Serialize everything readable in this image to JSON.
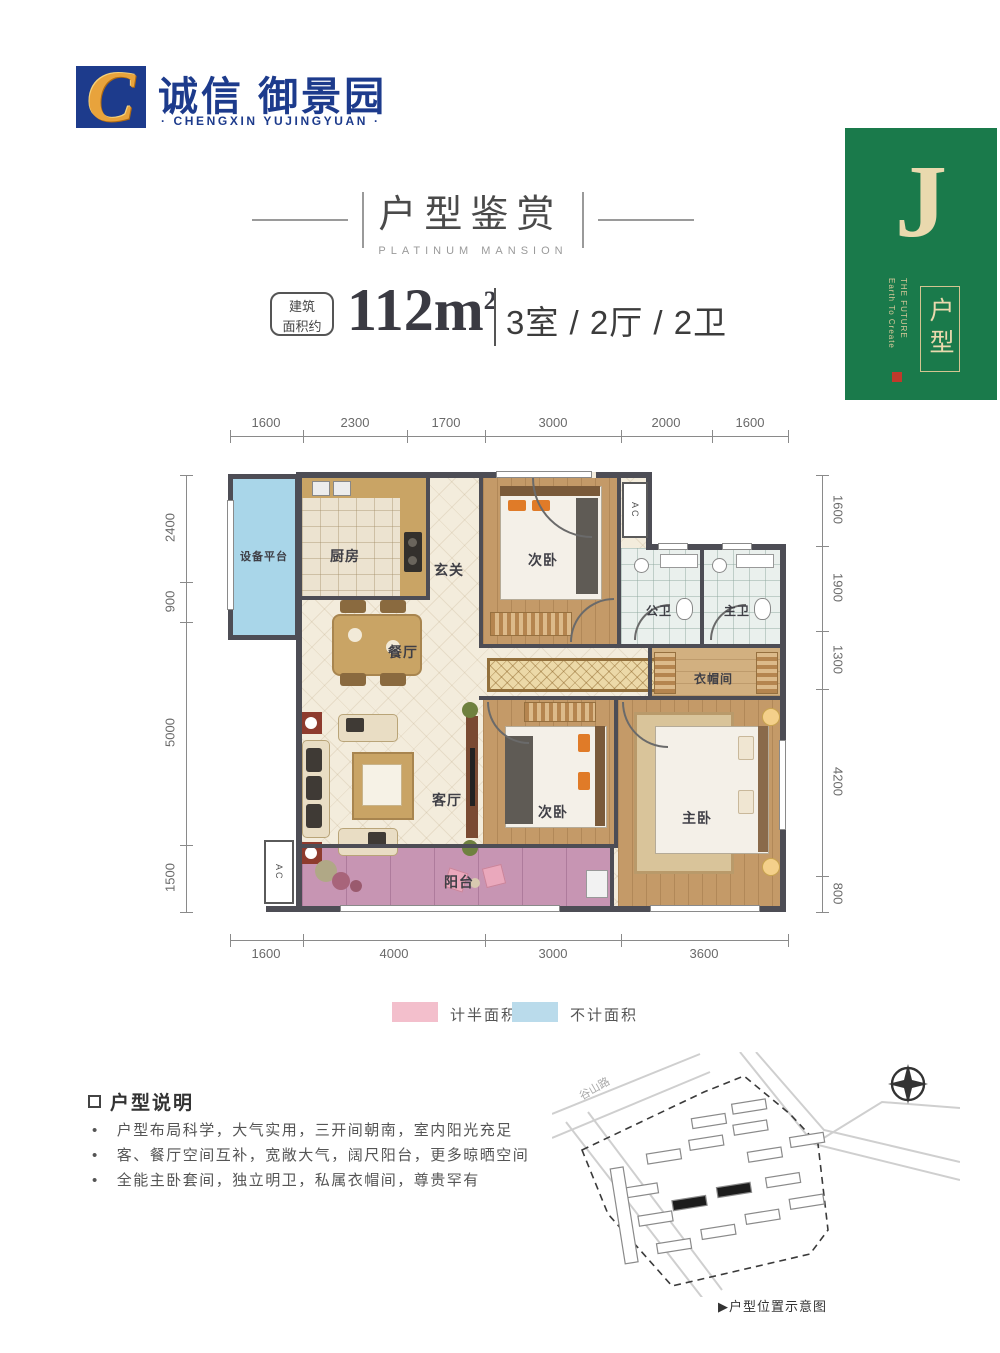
{
  "brand": {
    "logo_letter": "C",
    "name_cn": "诚信 御景园",
    "name_en": "· CHENGXIN YUJINGYUAN ·"
  },
  "title": {
    "main": "户型鉴赏",
    "sub": "PLATINUM MANSION"
  },
  "spec": {
    "area_tag_line1": "建筑",
    "area_tag_line2": "面积约",
    "area_value": "112m",
    "area_sup": "2",
    "layout": "3室 / 2厅 / 2卫"
  },
  "unit_card": {
    "letter": "J",
    "en_line1": "Earth To Create",
    "en_line2": "THE FUTURE",
    "label_vertical": "户型"
  },
  "dimensions": {
    "top": [
      "1600",
      "2300",
      "1700",
      "3000",
      "2000",
      "1600"
    ],
    "bottom": [
      "1600",
      "4000",
      "3000",
      "3600"
    ],
    "left": [
      "2400",
      "900",
      "5000",
      "1500"
    ],
    "right": [
      "1600",
      "1900",
      "1300",
      "4200",
      "800"
    ]
  },
  "rooms": {
    "equipment": "设备平台",
    "kitchen": "厨房",
    "foyer": "玄关",
    "bedroom_top": "次卧",
    "bath_public": "公卫",
    "bath_master": "主卫",
    "cloakroom": "衣帽间",
    "dining": "餐厅",
    "living": "客厅",
    "bedroom_mid": "次卧",
    "master": "主卧",
    "balcony": "阳台",
    "ac": "AC"
  },
  "legend": {
    "half_area_label": "计半面积",
    "not_counted_label": "不计面积",
    "half_area_color": "#f3bfcc",
    "not_counted_color": "#badbeb"
  },
  "description": {
    "heading": "户型说明",
    "bullets": [
      "户型布局科学，大气实用，三开间朝南，室内阳光充足",
      "客、餐厅空间互补，宽敞大气，阔尺阳台，更多晾晒空间",
      "全能主卧套间，独立明卫，私属衣帽间，尊贵罕有"
    ]
  },
  "sitemap": {
    "road1": "谷山路",
    "caption": "▶户型位置示意图"
  },
  "colors": {
    "brand_blue": "#1d3b8c",
    "brand_gold": "#e8a33c",
    "card_green": "#1a7a4b",
    "card_cream": "#ead9ae",
    "wall": "#4d4d55",
    "balcony_pink": "#c795b3",
    "equipment_blue": "#a9d6e9"
  }
}
